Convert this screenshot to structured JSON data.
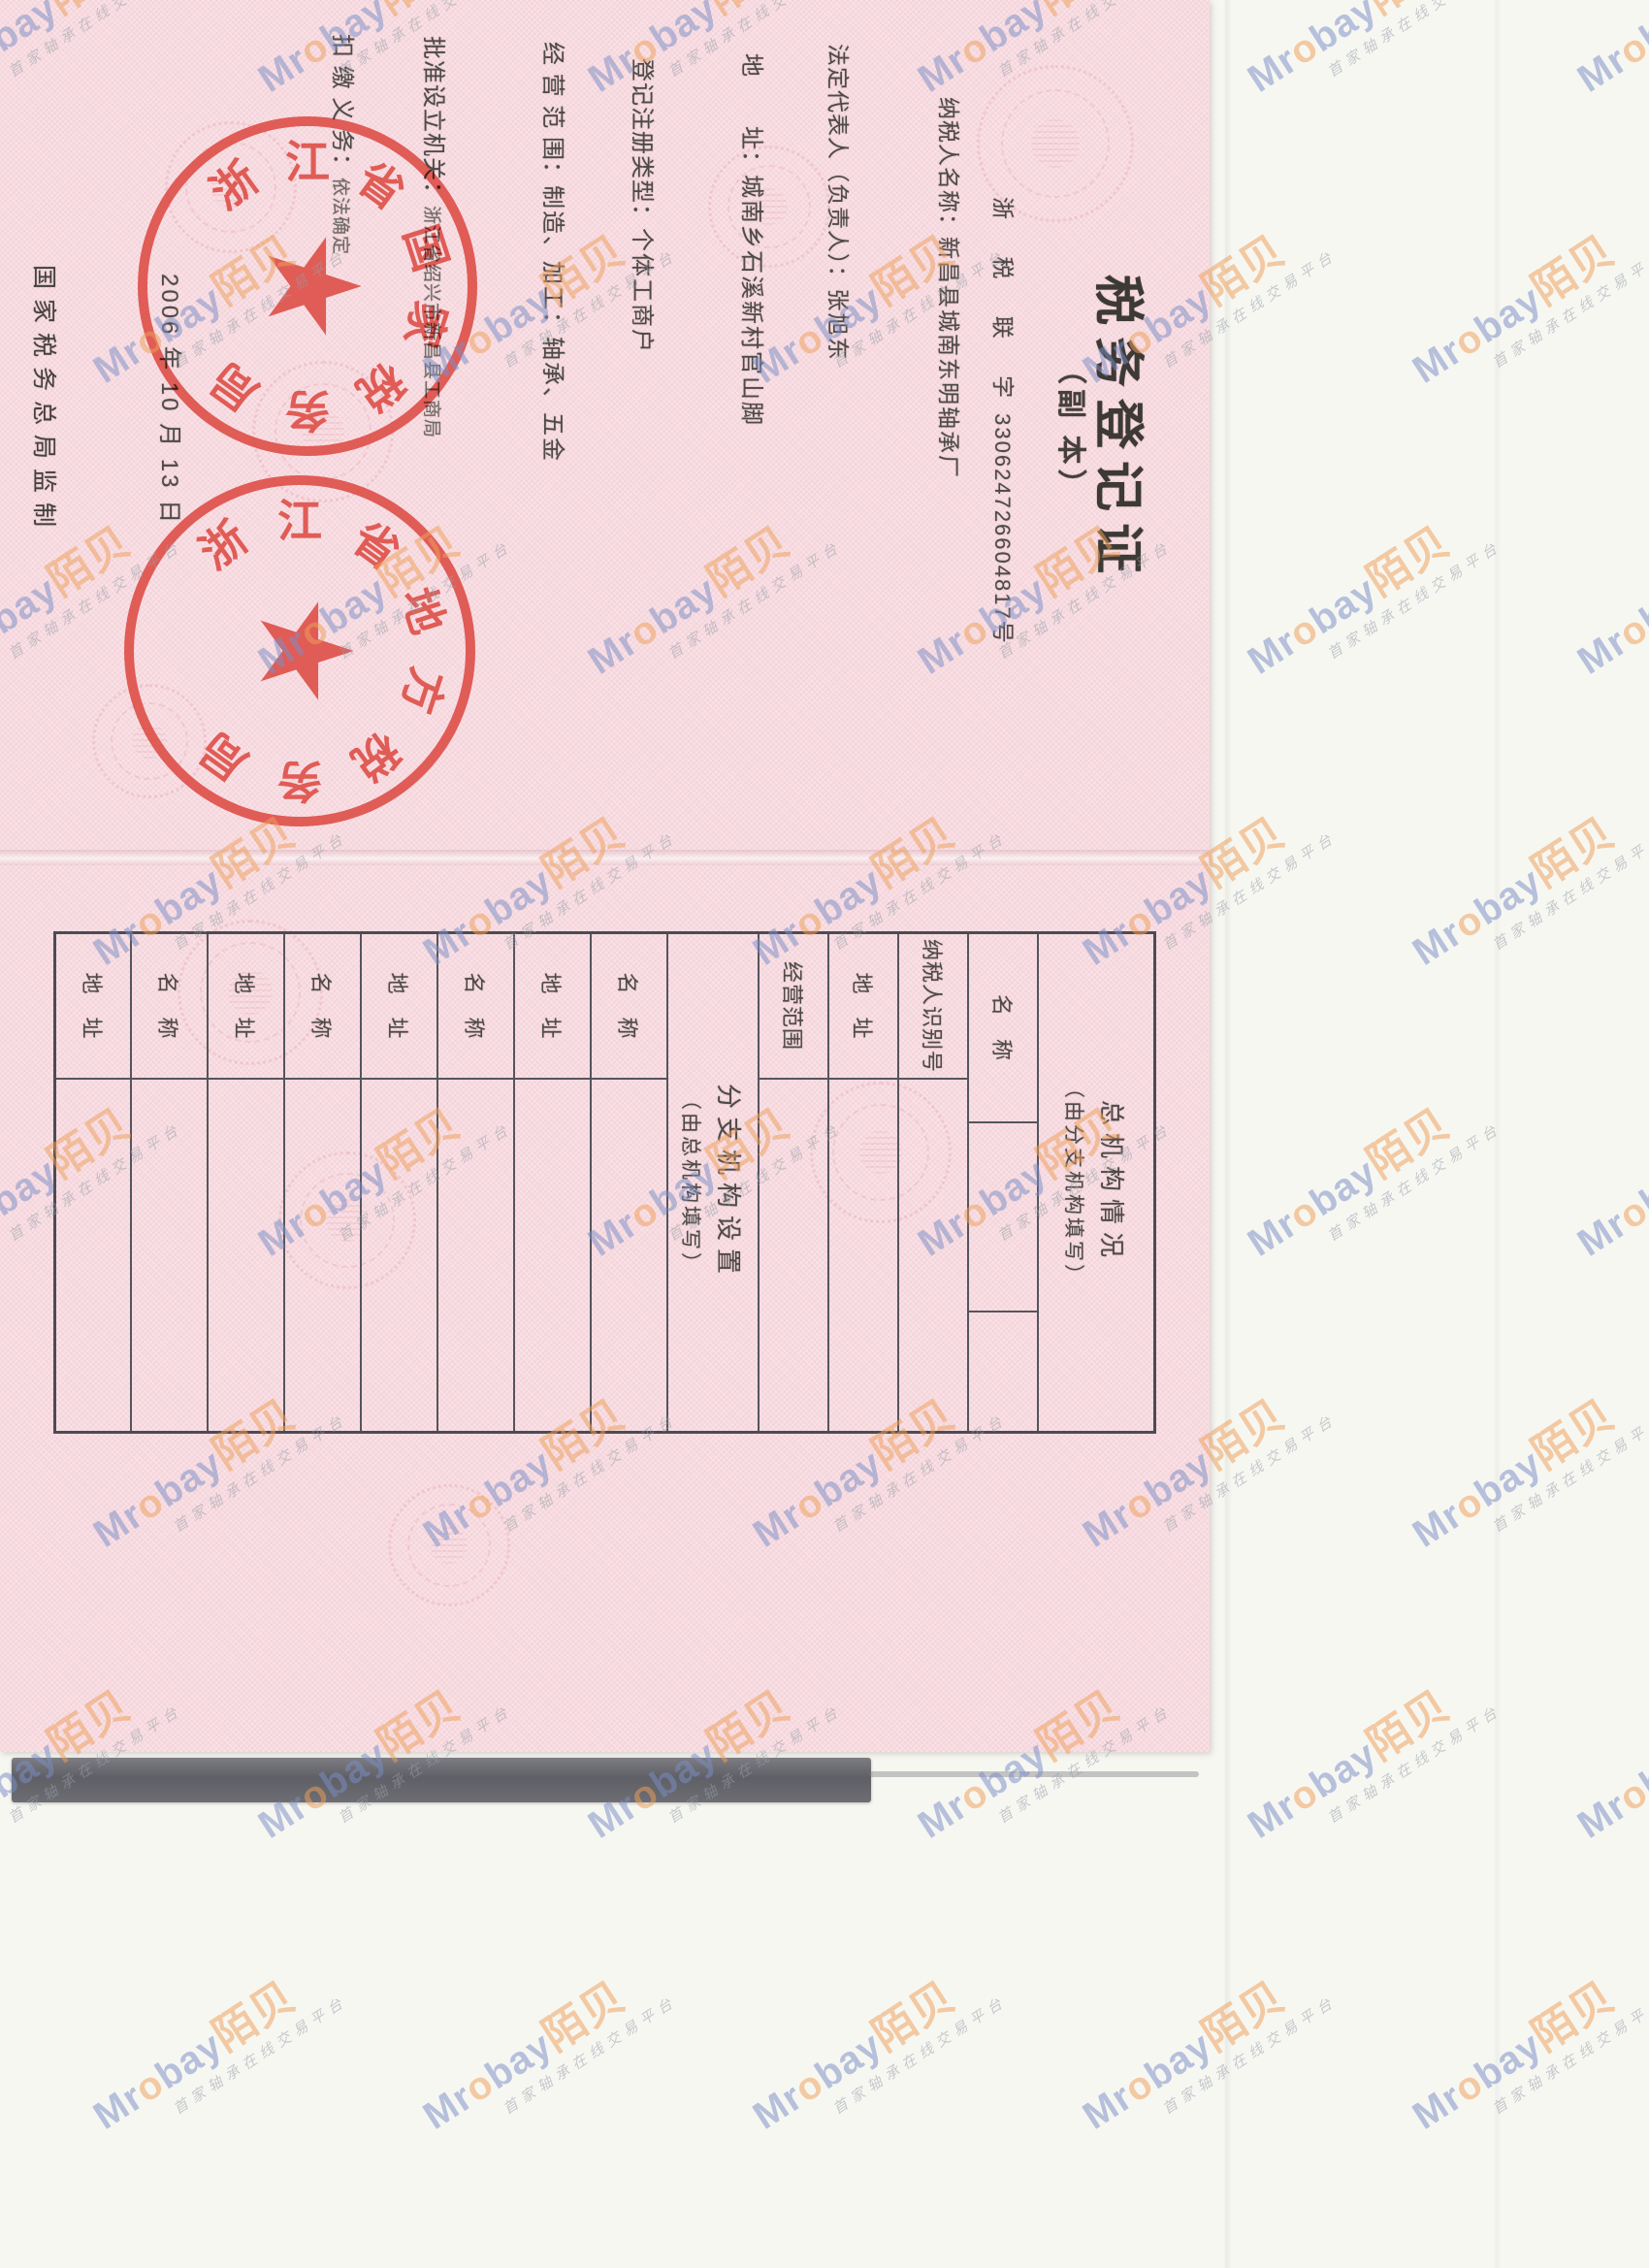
{
  "document": {
    "title": "税务登记证",
    "subtitle": "（副  本）",
    "serial": {
      "prefix": "浙 税 联 字",
      "number": "330624726604817",
      "suffix": "号"
    },
    "fields": [
      {
        "id": "taxpayer-name",
        "label": "纳税人名称：",
        "value": "新昌县城南东明轴承厂"
      },
      {
        "id": "legal-representative",
        "label": "法定代表人（负责人）：",
        "value": "张旭东"
      },
      {
        "id": "address",
        "label": "地　　址：",
        "value": "城南乡石溪新村官山脚"
      },
      {
        "id": "registration-type",
        "label": "登记注册类型：",
        "value": "个体工商户"
      },
      {
        "id": "business-scope",
        "label": "经 营 范 围：",
        "value": "制造、加工：轴承、五金"
      },
      {
        "id": "approving-authority",
        "label": "批准设立机关：",
        "value": "浙江省绍兴市新昌县工商局"
      },
      {
        "id": "withholding-obligation",
        "label": "扣 缴 义 务：",
        "value": "依法确定"
      }
    ],
    "issue_date": "2006 年 10 月 13 日",
    "footer": "国家税务总局监制",
    "stamp_star": "★",
    "stamps": [
      {
        "id": "national-tax-stamp",
        "text": "浙江省国家税务局"
      },
      {
        "id": "local-tax-stamp",
        "text": "浙江省地方税务局"
      }
    ],
    "back_table": {
      "rows": [
        {
          "type": "header",
          "h": 120,
          "line1": "总机构情况",
          "line2": "（由分支机构填写）"
        },
        {
          "type": "field",
          "h": 72,
          "label": "名　称",
          "label_w": 195,
          "extra_divider": true
        },
        {
          "type": "field",
          "h": 72,
          "label": "纳税人识别号",
          "label_w": 150
        },
        {
          "type": "field",
          "h": 72,
          "label": "地　址",
          "label_w": 150
        },
        {
          "type": "field",
          "h": 72,
          "label": "经营范围",
          "label_w": 150
        },
        {
          "type": "header",
          "h": 94,
          "line1": "分支机构设置",
          "line2": "（由总机构填写）"
        },
        {
          "type": "field",
          "h": 79,
          "label": "名　称",
          "label_w": 150
        },
        {
          "type": "field",
          "h": 79,
          "label": "地　址",
          "label_w": 150
        },
        {
          "type": "field",
          "h": 79,
          "label": "名　称",
          "label_w": 150
        },
        {
          "type": "field",
          "h": 79,
          "label": "地　址",
          "label_w": 150
        },
        {
          "type": "field",
          "h": 79,
          "label": "名　称",
          "label_w": 150
        },
        {
          "type": "field",
          "h": 79,
          "label": "地　址",
          "label_w": 150
        },
        {
          "type": "field",
          "h": 79,
          "label": "名　称",
          "label_w": 150
        },
        {
          "type": "field",
          "h": 0,
          "label": "地　址",
          "label_w": 150
        }
      ]
    }
  },
  "watermark": {
    "brand_m": "Mr",
    "brand_o": "o",
    "brand_bay": "bay",
    "brand_cn": "陌贝",
    "tagline": "首家轴承在线交易平台"
  },
  "colors": {
    "stamp_red": "#dd4a42",
    "watermark_blue": "#7b8fc7",
    "watermark_orange": "#eea05a",
    "paper_pink": "#f7dbe1",
    "ink": "#4e4a48"
  }
}
